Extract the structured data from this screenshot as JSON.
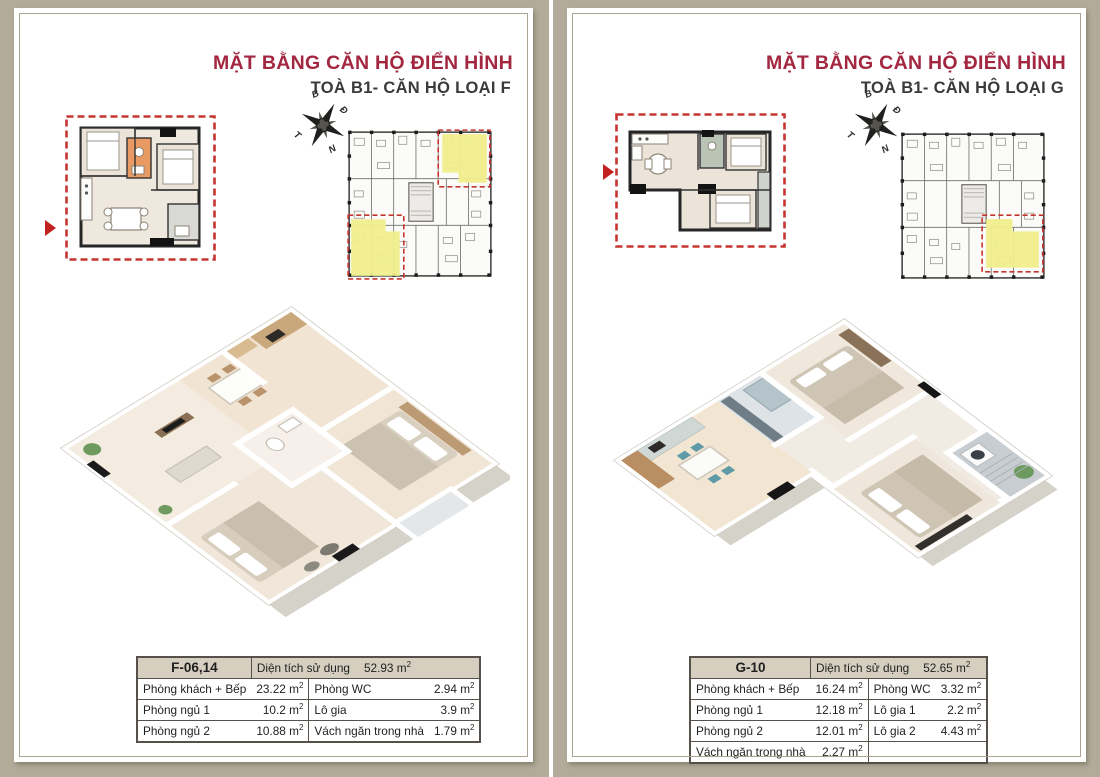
{
  "colors": {
    "page_background": "#b2ab9a",
    "title_red": "#a32740",
    "highlight_yellow": "#f0ee8c",
    "dashed_red": "#c63430",
    "table_header_bg": "#d6cfc0"
  },
  "panels": [
    {
      "title": "MẶT BẰNG CĂN HỘ ĐIỂN HÌNH",
      "subtitle": "TOÀ B1- CĂN HỘ LOẠI F",
      "compass": {
        "north_label": "B",
        "east_label": "Đ",
        "west_label": "T",
        "south_label": "N"
      },
      "table": {
        "unit_code": "F-06,14",
        "area_label": "Diện tích sử dụng",
        "total_area": "52.93 m²",
        "rows": [
          [
            {
              "label": "Phòng khách + Bếp",
              "value": "23.22 m²"
            },
            {
              "label": "Phòng WC",
              "value": "2.94 m²"
            }
          ],
          [
            {
              "label": "Phòng ngủ 1",
              "value": "10.2 m²"
            },
            {
              "label": "Lô gia",
              "value": "3.9 m²"
            }
          ],
          [
            {
              "label": "Phòng ngủ 2",
              "value": "10.88 m²"
            },
            {
              "label": "Vách ngăn trong nhà",
              "value": "1.79 m²"
            }
          ]
        ]
      }
    },
    {
      "title": "MẶT BẰNG CĂN HỘ ĐIỂN HÌNH",
      "subtitle": "TOÀ B1- CĂN HỘ LOẠI G",
      "compass": {
        "north_label": "B",
        "east_label": "Đ",
        "west_label": "T",
        "south_label": "N"
      },
      "table": {
        "unit_code": "G-10",
        "area_label": "Diện tích sử dụng",
        "total_area": "52.65 m²",
        "rows": [
          [
            {
              "label": "Phòng khách + Bếp",
              "value": "16.24 m²"
            },
            {
              "label": "Phòng WC",
              "value": "3.32 m²"
            }
          ],
          [
            {
              "label": "Phòng ngủ 1",
              "value": "12.18 m²"
            },
            {
              "label": "Lô gia 1",
              "value": "2.2 m²"
            }
          ],
          [
            {
              "label": "Phòng ngủ 2",
              "value": "12.01 m²"
            },
            {
              "label": "Lô gia 2",
              "value": "4.43 m²"
            }
          ],
          [
            {
              "label": "Vách ngăn trong nhà",
              "value": "2.27 m²"
            },
            {
              "label": "",
              "value": ""
            }
          ]
        ]
      }
    }
  ]
}
